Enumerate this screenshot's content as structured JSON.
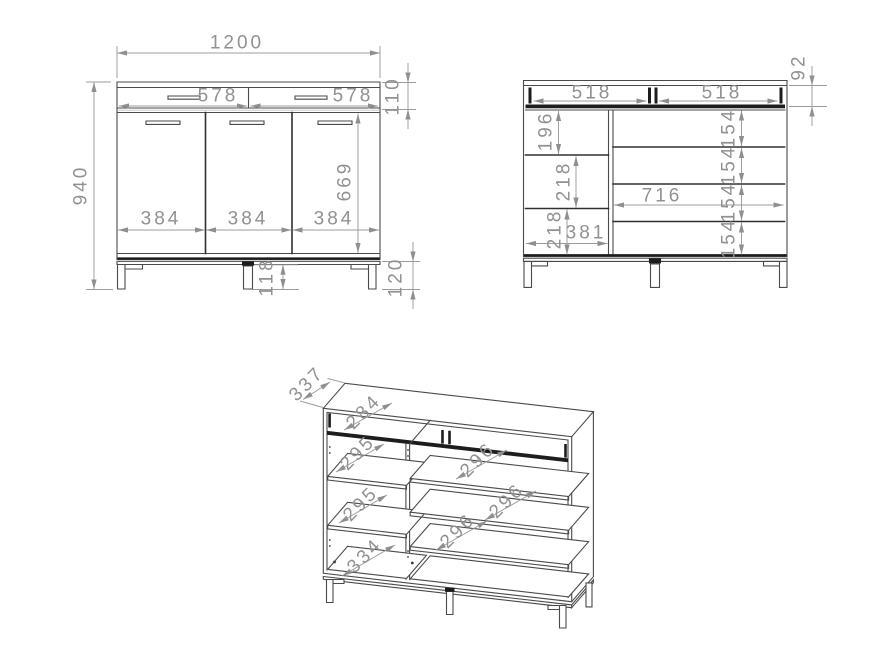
{
  "document": {
    "type": "furniture technical drawing",
    "background": "#ffffff",
    "object_line_color": "#4a4a4a",
    "dimension_color": "#9c9c9c"
  },
  "front_view": {
    "total_width": "1200",
    "total_height": "940",
    "drawer_width_left": "578",
    "drawer_width_right": "578",
    "drawer_front_height": "110",
    "door_width_1": "384",
    "door_width_2": "384",
    "door_width_3": "384",
    "door_height": "669",
    "center_leg_height": "118",
    "leg_height": "120"
  },
  "internal_view": {
    "drawer_opening_left": "518",
    "drawer_opening_right": "518",
    "drawer_inner_height": "92",
    "left_compartment_1": "196",
    "left_compartment_2": "218",
    "left_compartment_3": "218",
    "left_inner_width": "381",
    "right_inner_width": "716",
    "right_compartment_1": "154",
    "right_compartment_2": "154",
    "right_compartment_3": "154",
    "right_compartment_4": "154"
  },
  "isometric_view": {
    "depth": "337",
    "drawer_depth": "284",
    "left_shelf_depth_1": "295",
    "left_shelf_depth_2": "295",
    "left_bottom_depth": "334",
    "right_shelf_depth_1": "296",
    "right_shelf_depth_2": "296",
    "right_shelf_depth_3": "296"
  }
}
